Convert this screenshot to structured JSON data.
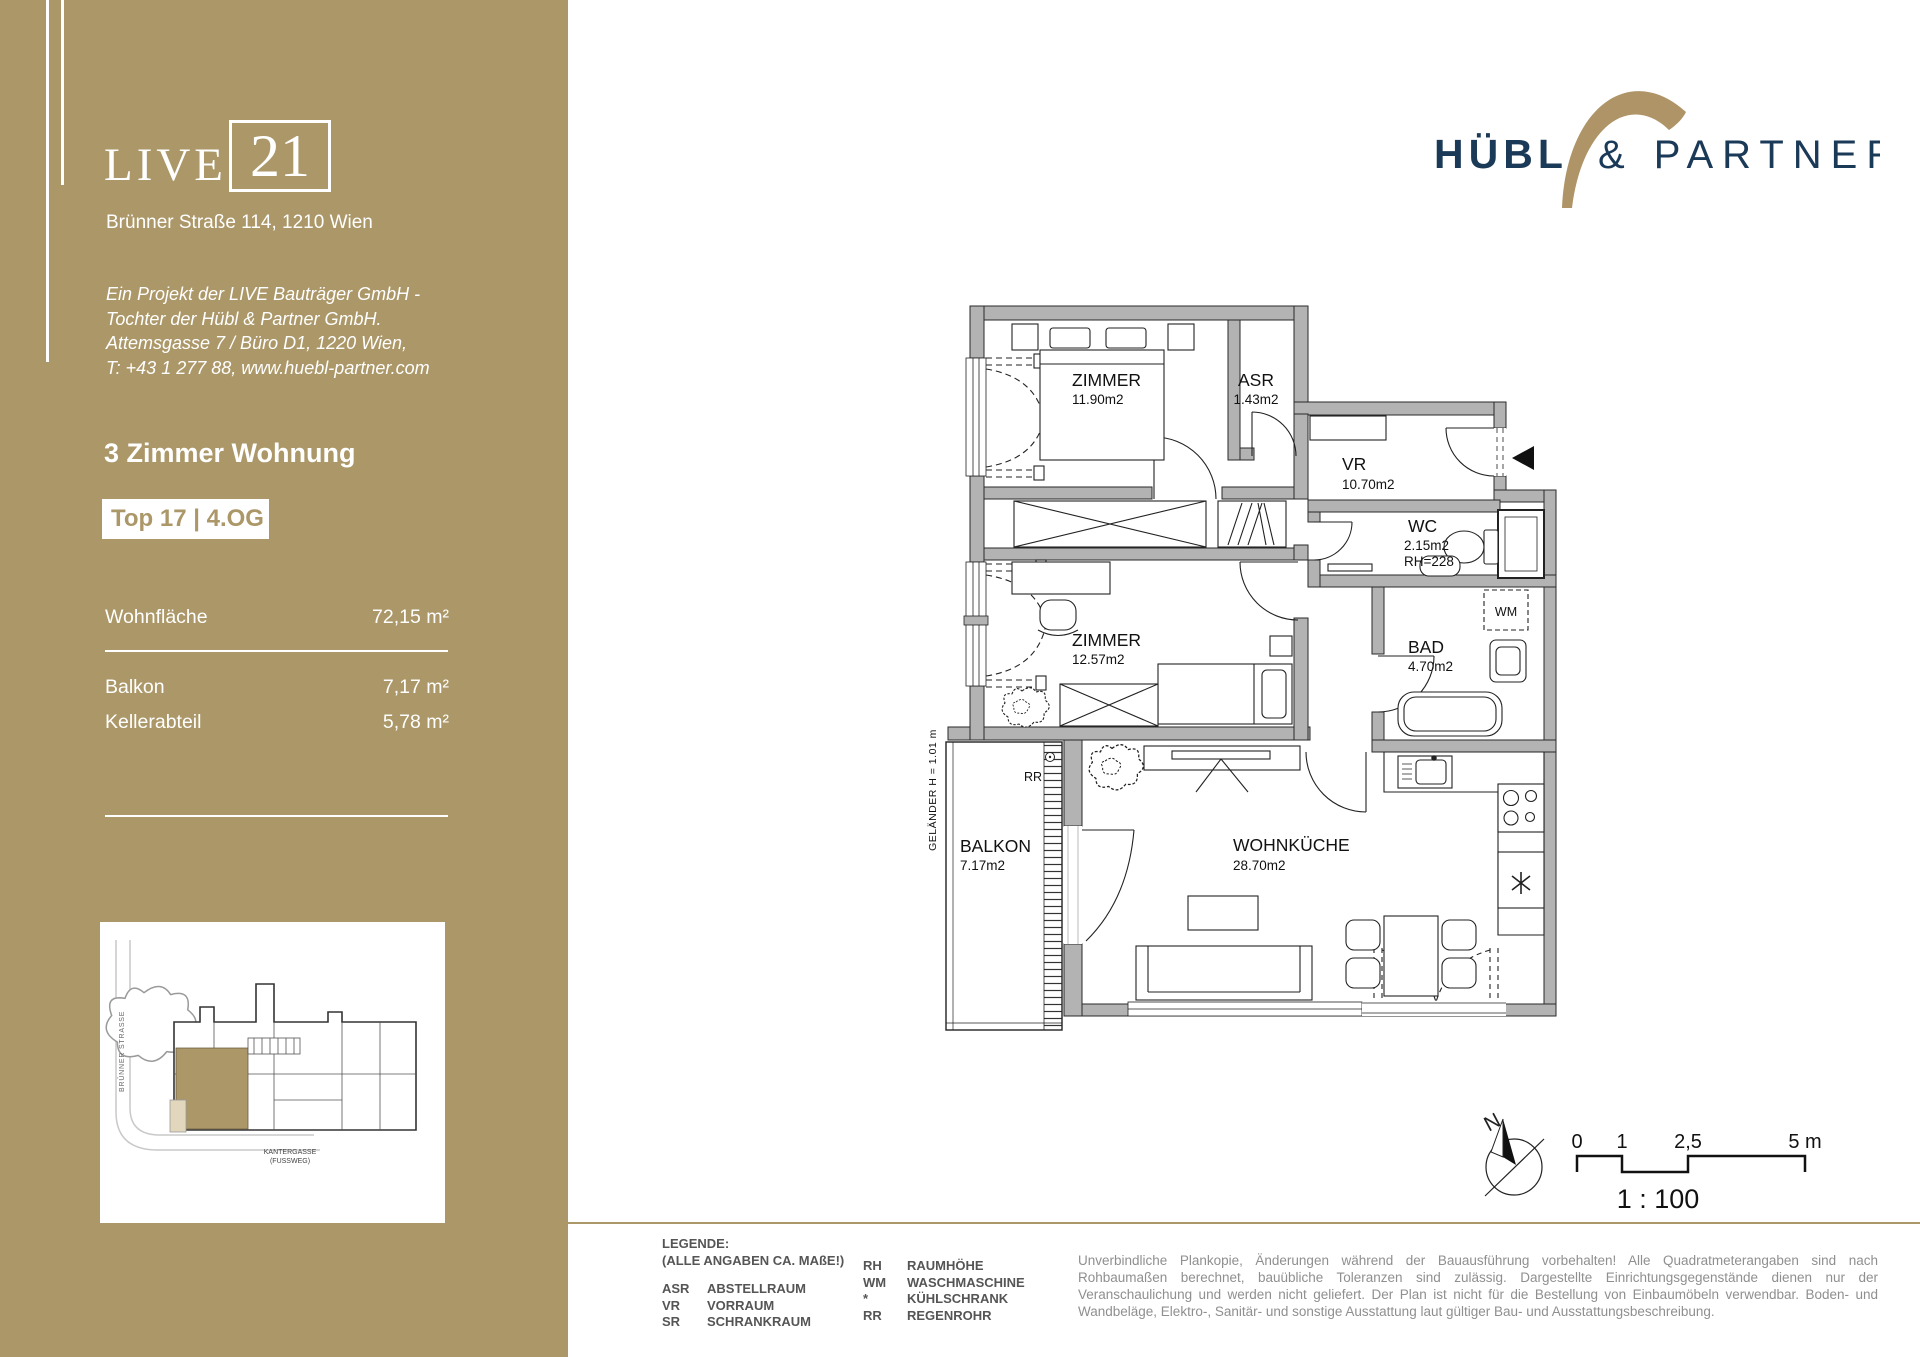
{
  "sidebar": {
    "logo_live": "LIVE",
    "logo_21": "21",
    "address": "Brünner Straße 114, 1210 Wien",
    "project_lines": [
      "Ein Projekt der LIVE Bauträger GmbH -",
      "Tochter der Hübl & Partner GmbH.",
      "Attemsgasse 7 / Büro D1, 1220 Wien,",
      "T: +43 1 277 88, www.huebl-partner.com"
    ],
    "apartment_title": "3 Zimmer Wohnung",
    "unit_badge": "Top 17 | 4.OG",
    "area_rows": [
      {
        "label": "Wohnfläche",
        "value": "72,15 m²"
      },
      {
        "label": "Balkon",
        "value": "7,17 m²"
      },
      {
        "label": "Kellerabteil",
        "value": "5,78 m²"
      }
    ],
    "site_map": {
      "street_label": "BRÜNNER STRASSE",
      "path_label_line1": "KANTERGASSE",
      "path_label_line2": "(FUSSWEG)"
    }
  },
  "brand": {
    "primary": "HÜBL",
    "secondary": "& PARTNER"
  },
  "floor_plan": {
    "rooms": [
      {
        "name": "ZIMMER",
        "area": "11.90m2"
      },
      {
        "name": "ASR",
        "area": "1.43m2"
      },
      {
        "name": "VR",
        "area": "10.70m2"
      },
      {
        "name": "WC",
        "area": "2.15m2",
        "note": "RH=228"
      },
      {
        "name": "BAD",
        "area": "4.70m2"
      },
      {
        "name": "ZIMMER",
        "area": "12.57m2"
      },
      {
        "name": "WOHNKÜCHE",
        "area": "28.70m2"
      },
      {
        "name": "BALKON",
        "area": "7.17m2"
      }
    ],
    "labels": {
      "wm": "WM",
      "rr": "RR",
      "gelaender": "GELÄNDER  H = 1.01 m",
      "north": "N"
    }
  },
  "scale_bar": {
    "ticks": [
      "0",
      "1",
      "2,5",
      "5 m"
    ],
    "ratio": "1 : 100"
  },
  "legend": {
    "title": "LEGENDE:",
    "subtitle": "(ALLE ANGABEN CA. MAßE!)",
    "col1": [
      {
        "abbr": "ASR",
        "term": "ABSTELLRAUM"
      },
      {
        "abbr": "VR",
        "term": "VORRAUM"
      },
      {
        "abbr": "SR",
        "term": "SCHRANKRAUM"
      }
    ],
    "col2": [
      {
        "abbr": "RH",
        "term": "RAUMHÖHE"
      },
      {
        "abbr": "WM",
        "term": "WASCHMASCHINE"
      },
      {
        "abbr": "*",
        "term": "KÜHLSCHRANK"
      },
      {
        "abbr": "RR",
        "term": "REGENROHR"
      }
    ]
  },
  "disclaimer": "Unverbindliche Plankopie, Änderungen während der Bauausführung vorbehalten! Alle Quadratmeterangaben sind nach Rohbaumaßen berechnet, bauübliche Toleranzen sind zulässig.  Dargestellte Einrichtungsgegenstände dienen nur der Veranschaulichung und werden nicht geliefert. Der Plan ist nicht für die Bestellung von Einbaumöbeln verwendbar. Boden- und Wandbeläge, Elektro-, Sanitär- und sonstige Ausstattung laut gültiger Bau- und Ausstattungsbeschreibung.",
  "colors": {
    "tan": "#ab9768",
    "navy": "#1b3a58"
  }
}
